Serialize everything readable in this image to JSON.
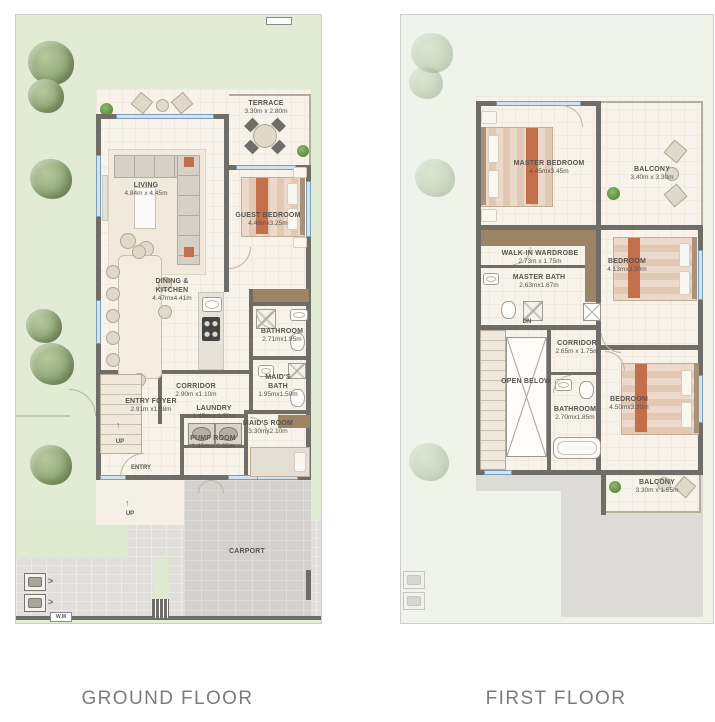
{
  "colors": {
    "garden": "#e2ecd4",
    "garden_faded": "#eff3ea",
    "floor_cream": "#f8f3ea",
    "wall": "#6f6d68",
    "wardrobe_wood": "#9d8465",
    "accent_terracotta": "#c46f4c",
    "window_blue": "#cfe3f2",
    "paving_gray": "#d2d1ce",
    "label_text": "#56544e",
    "caption_text": "#7c7c7c"
  },
  "icons": {
    "tree-icon": "green foliage blob",
    "bush-icon": "small green circle",
    "door-arc-icon": "quarter-circle swing",
    "window-icon": "blue strip in wall",
    "stairs-icon": "striped treads",
    "open-void-icon": "x-crossed box",
    "utility-meter-icon": "boxed square with chevrons",
    "washer-icon": "square with drum circle",
    "stove-icon": "dark square with 4 burners"
  },
  "floors": {
    "ground": {
      "caption": "GROUND FLOOR",
      "rooms": {
        "terrace": {
          "name": "TERRACE",
          "dims": "3.30m x 2.80m"
        },
        "living": {
          "name": "LIVING",
          "dims": "4.84m x 4.45m"
        },
        "guest_bedroom": {
          "name": "GUEST BEDROOM",
          "dims": "4.48mx3.25m"
        },
        "dining_kitchen": {
          "name": "DINING & KITCHEN",
          "dims": "4.47mx4.41m"
        },
        "bathroom": {
          "name": "BATHROOM",
          "dims": "2.71mx1.95m"
        },
        "corridor": {
          "name": "CORRIDOR",
          "dims": "2.90m x1.10m"
        },
        "maids_bath": {
          "name": "MAID'S BATH",
          "dims": "1.95mx1.50m"
        },
        "entry_foyer": {
          "name": "ENTRY FOYER",
          "dims": "2.91m x1.88m"
        },
        "laundry": {
          "name": "LAUNDRY",
          "dims": "1.45m x 1.50m"
        },
        "maids_room": {
          "name": "MAID'S ROOM",
          "dims": "3.30mx2.10m"
        },
        "pump_room": {
          "name": "PUMP ROOM",
          "dims": "1.45m x 0.65m"
        },
        "carport": {
          "name": "CARPORT"
        }
      },
      "misc": {
        "entry": "ENTRY",
        "up": "UP",
        "wm": "W.M"
      }
    },
    "first": {
      "caption": "FIRST FLOOR",
      "rooms": {
        "master_bedroom": {
          "name": "MASTER BEDROOM",
          "dims": "4.45mx3.45m"
        },
        "balcony_top": {
          "name": "BALCONY",
          "dims": "3.40m x 3.30m"
        },
        "walk_in_wardrobe": {
          "name": "WALK-IN WARDROBE",
          "dims": "2.73m x 1.75m"
        },
        "master_bath": {
          "name": "MASTER BATH",
          "dims": "2.63mx1.67m"
        },
        "bedroom_mid": {
          "name": "BEDROOM",
          "dims": "4.13mx3.30m"
        },
        "corridor": {
          "name": "CORRIDOR",
          "dims": "2.65m x 1.75m"
        },
        "open_below": {
          "name": "OPEN BELOW"
        },
        "bathroom": {
          "name": "BATHROOM",
          "dims": "2.70mx1.85m"
        },
        "bedroom_low": {
          "name": "BEDROOM",
          "dims": "4.50mx3.30m"
        },
        "balcony_bottom": {
          "name": "BALCONY",
          "dims": "3.30m x 1.55m"
        }
      },
      "misc": {
        "dn": "DN"
      }
    }
  }
}
